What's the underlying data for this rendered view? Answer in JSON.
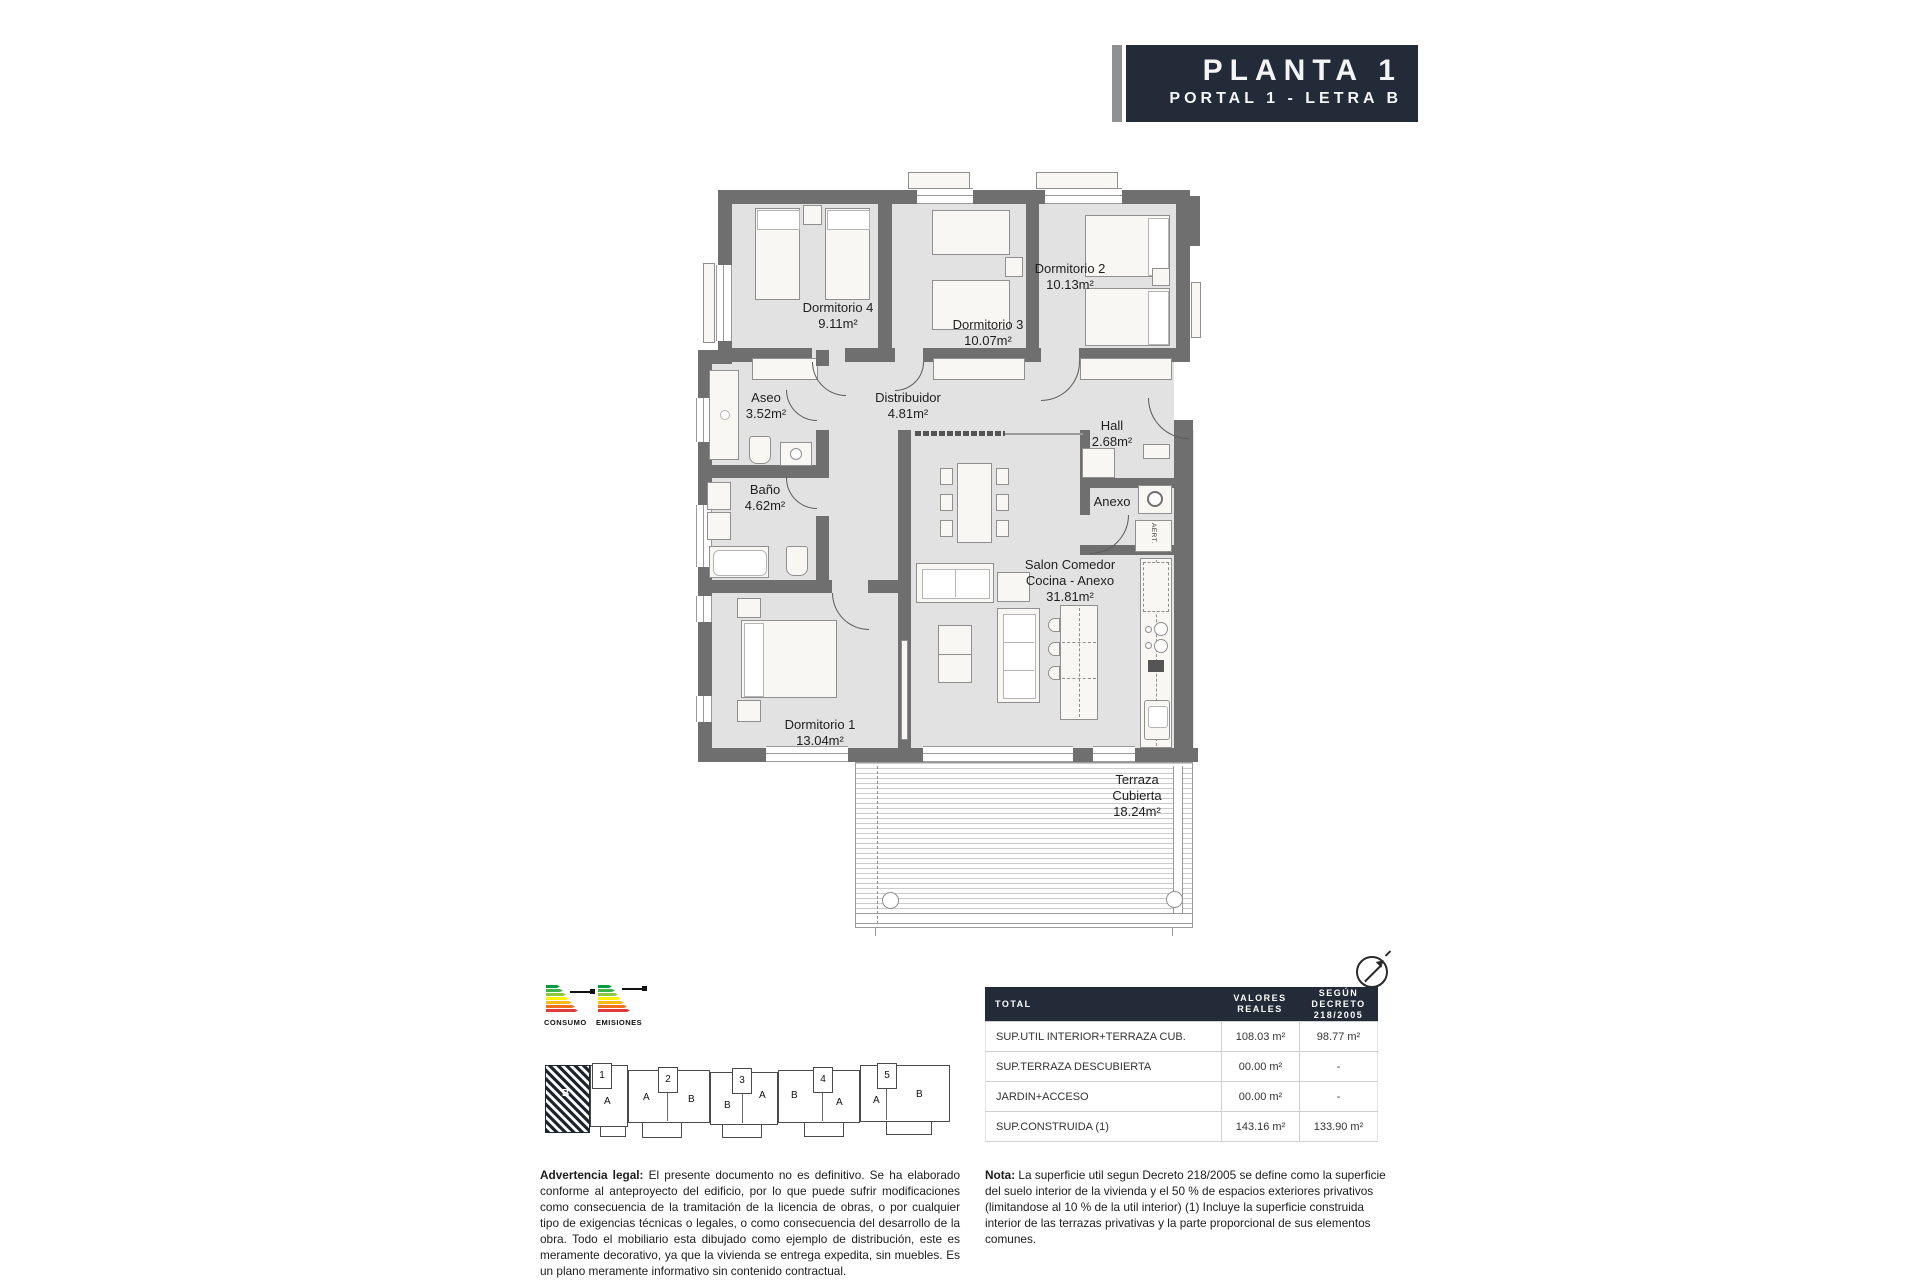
{
  "title_block": {
    "floor": "PLANTA 1",
    "unit": "PORTAL 1 - LETRA B"
  },
  "plan": {
    "rooms": {
      "dormitorio4": {
        "name": "Dormitorio 4",
        "area": "9.11m²"
      },
      "dormitorio3": {
        "name": "Dormitorio 3",
        "area": "10.07m²"
      },
      "dormitorio2": {
        "name": "Dormitorio 2",
        "area": "10.13m²"
      },
      "aseo": {
        "name": "Aseo",
        "area": "3.52m²"
      },
      "distribuidor": {
        "name": "Distribuidor",
        "area": "4.81m²"
      },
      "hall": {
        "name": "Hall",
        "area": "2.68m²"
      },
      "banio": {
        "name": "Baño",
        "area": "4.62m²"
      },
      "anexo": {
        "name": "Anexo"
      },
      "salon": {
        "name_line1": "Salon Comedor",
        "name_line2": "Cocina - Anexo",
        "area": "31.81m²"
      },
      "dormitorio1": {
        "name": "Dormitorio 1",
        "area": "13.04m²"
      },
      "terraza": {
        "name_line1": "Terraza",
        "name_line2": "Cubierta",
        "area": "18.24m²"
      }
    },
    "closet_label": "AERT."
  },
  "energy": {
    "consumo_label": "CONSUMO",
    "emisiones_label": "EMISIONES",
    "scale_colors": [
      "#009a44",
      "#3db54a",
      "#8dc63f",
      "#fff200",
      "#fdb913",
      "#f3701b",
      "#e03a3e"
    ]
  },
  "site_plan": {
    "hatched_letter": "B",
    "blocks": [
      {
        "num": "1",
        "letters": [
          "A"
        ]
      },
      {
        "num": "2",
        "letters": [
          "A",
          "B"
        ]
      },
      {
        "num": "3",
        "letters": [
          "B",
          "A"
        ]
      },
      {
        "num": "4",
        "letters": [
          "B",
          "A"
        ]
      },
      {
        "num": "5",
        "letters": [
          "A",
          "B"
        ]
      }
    ]
  },
  "surface_table": {
    "headers": [
      "TOTAL",
      "VALORES REALES",
      "SEGÚN DECRETO 218/2005"
    ],
    "rows": [
      [
        "SUP.UTIL INTERIOR+TERRAZA CUB.",
        "108.03 m²",
        "98.77 m²"
      ],
      [
        "SUP.TERRAZA DESCUBIERTA",
        "00.00 m²",
        "-"
      ],
      [
        "JARDIN+ACCESO",
        "00.00 m²",
        "-"
      ],
      [
        "SUP.CONSTRUIDA (1)",
        "143.16 m²",
        "133.90 m²"
      ]
    ]
  },
  "legal": {
    "lead": "Advertencia legal:",
    "body": " El presente documento no es definitivo. Se ha elaborado conforme al anteproyecto del edificio, por lo que puede sufrir modificaciones como consecuencia de la tramitación de la licencia de obras, o por cualquier tipo de exigencias técnicas o legales, o como consecuencia del desarrollo de la obra. Todo el mobiliario esta dibujado como ejemplo de distribución, este es meramente decorativo, ya que la vivienda se entrega expedita, sin muebles. Es un plano meramente informativo sin contenido contractual."
  },
  "note": {
    "lead": "Nota:",
    "body": " La superficie util segun Decreto 218/2005 se define como la superficie del suelo interior de la vivienda y el 50 % de espacios exteriores privativos (limitandose al 10 % de la util interior) (1) Incluye la superficie construida interior de las terrazas privativas y la parte proporcional de sus elementos comunes."
  },
  "colors": {
    "wall": "#6f6f6f",
    "floor": "#e3e2e2",
    "navy": "#232b38"
  }
}
